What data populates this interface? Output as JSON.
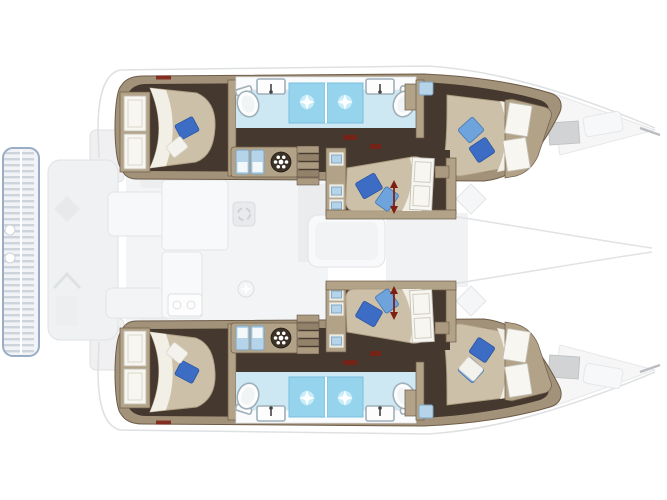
{
  "diagram": {
    "kind": "boat-floor-plan",
    "subject": "sailing-catamaran interior layout",
    "view": "top-down deck plan",
    "orientation": "bow-right, stern-left",
    "rendering": "below-deck accommodations drawn solid; above-deck (cockpit, saloon, galley, foredeck) ghosted in pale gray"
  },
  "palette": {
    "background": "#ffffff",
    "hull-wall": "#a3927a",
    "room-tan": "#b2a288",
    "floor-dark": "#44382f",
    "bed-beige": "#ccc0a8",
    "duvet-white": "#f2efe7",
    "pillow-blue": "#3c6cc4",
    "pillow-blue-light": "#6fa3dc",
    "pillow-white": "#f3f2ec",
    "bath-floor": "#cde8f2",
    "shower-blue": "#96d4ee",
    "locker-blue": "#b5d4ea",
    "fixture-stroke": "#9fb0ba",
    "step-tan": "#ab9a80",
    "wheel-dark": "#3c3127",
    "accent-red": "#7e1f13",
    "ghost-fill": "#ededef",
    "ghost-stroke": "#d6d9dc",
    "platform-stroke": "#8299b8"
  },
  "vessel": {
    "hulls": [
      {
        "name": "top-hull",
        "cabins": [
          {
            "name": "aft-double-cabin",
            "bed": "double, head inboard",
            "pillows": [
              "blue",
              "white"
            ],
            "wardrobe": "two white doors aft"
          },
          {
            "name": "forward-double-cabin",
            "bed": "double, angled with hull taper",
            "pillows": [
              "light-blue",
              "blue"
            ],
            "wardrobe": "two white doors forward"
          }
        ],
        "heads": [
          {
            "name": "aft-head",
            "fixtures": [
              "toilet",
              "sink-with-faucet",
              "shower-with-drain-light"
            ]
          },
          {
            "name": "forward-head",
            "fixtures": [
              "shower-with-drain-light",
              "sink-with-faucet",
              "toilet"
            ]
          }
        ],
        "passage": [
          "twin-lockers",
          "wheel-hatch",
          "companionway-steps"
        ]
      },
      {
        "name": "bottom-hull",
        "cabins": [
          {
            "name": "aft-double-cabin",
            "bed": "double, head inboard",
            "pillows": [
              "white",
              "blue"
            ],
            "wardrobe": "two white doors aft"
          },
          {
            "name": "forward-double-cabin",
            "bed": "double, angled with hull taper",
            "pillows": [
              "blue",
              "white"
            ],
            "wardrobe": "two white doors forward"
          }
        ],
        "heads": [
          {
            "name": "aft-head",
            "fixtures": [
              "toilet",
              "sink-with-faucet",
              "shower-with-drain-light"
            ]
          },
          {
            "name": "forward-head",
            "fixtures": [
              "shower-with-drain-light",
              "sink-with-faucet",
              "toilet"
            ]
          }
        ],
        "passage": [
          "twin-lockers",
          "wheel-hatch",
          "companionway-steps"
        ]
      }
    ],
    "midship_cabins": [
      {
        "name": "upper-mid-cabin",
        "bed": "double with two blue pillows",
        "wardrobe_door": "white panel door",
        "marker": "red double-headed length arrow",
        "shelves": "inboard shelf column with blue gear"
      },
      {
        "name": "lower-mid-cabin",
        "bed": "double with two blue pillows",
        "wardrobe_door": "white panel door",
        "marker": "red double-headed length arrow",
        "shelves": "inboard shelf column with blue gear"
      }
    ],
    "ghosted_deck": [
      "aft-swim-platform-with-slats",
      "transom-steps",
      "cockpit-seating",
      "cockpit-table",
      "galley-counters",
      "galley-sink",
      "ceiling-light-starburst",
      "saloon-table",
      "foredeck-hatches",
      "deck-diamond-hatches",
      "bow-outline"
    ]
  },
  "counts": {
    "double_beds": 6,
    "toilets": 4,
    "sinks_in_heads": 4,
    "showers": 4,
    "companionway_steps": 2,
    "red_length_arrows": 2
  },
  "icons": {
    "wheel-hatch-icon": "dark circle ringed by white dots",
    "shower-drain-icon": "white four-point starburst on blue square",
    "twin-locker-icon": "pair of small blue cabinets with white fronts",
    "length-arrow-icon": "vertical dark-red double-headed arrow",
    "toilet-icon": "white oval with inner rim",
    "sink-icon": "white rounded rectangle with dark faucet stem"
  }
}
